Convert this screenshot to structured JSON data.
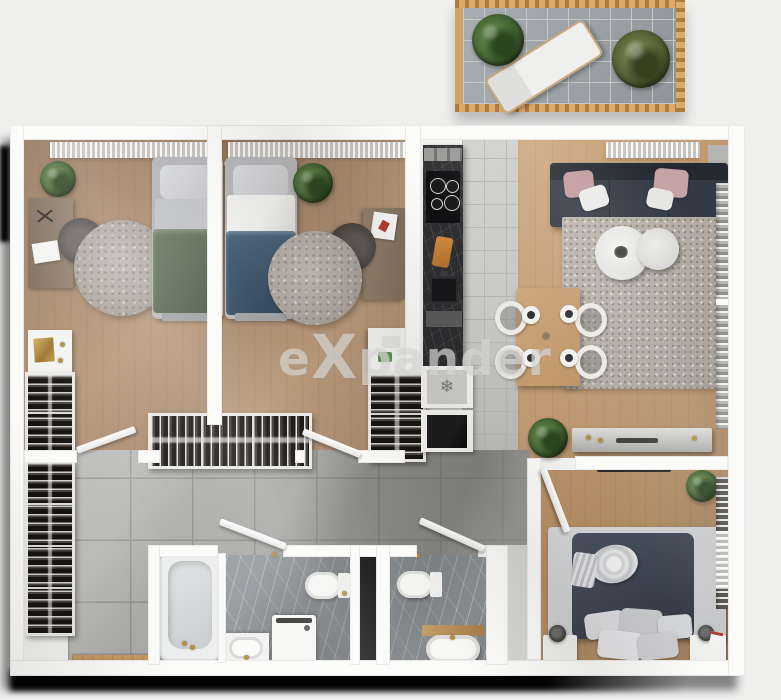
{
  "watermark": {
    "prefix": "e",
    "x": "X",
    "suffix": "pander"
  },
  "icons": {
    "snowflake": "❄"
  },
  "palette": {
    "bg": "#efefee",
    "wall": "#fbfbfa",
    "shadow": "#050505",
    "wood_bedroom": "#a5876a",
    "wood_living": "#c39c73",
    "wood_bedroom3": "#ad8a61",
    "tile_kitchen": "#c6c6c4",
    "tile_hallway": "#a5a5a3",
    "marble_bathroom": "#8d9296",
    "counter_dark": "#29292c",
    "sofa_navy": "#333a45",
    "duvet_green": "#5f7059",
    "duvet_blue": "#41586e",
    "duvet_navy": "#3c4350",
    "pillow_pink": "#c29a9e",
    "rug_gray": "#b0aaa2",
    "balcony_wood": "#d2a264",
    "balcony_tile": "#9ba1a4",
    "plant_green": "#3c5a2e",
    "gold": "#b08c3e",
    "watermark_gray": "#e2e2e0"
  },
  "scene": {
    "type": "3d-apartment-floor-plan-top-view",
    "balcony": {
      "furniture": [
        "sun-lounger",
        "plant",
        "plant"
      ]
    },
    "rooms": [
      {
        "name": "bedroom-1",
        "furniture": [
          "single-bed-green",
          "desk",
          "desk-chair",
          "round-rug",
          "plant",
          "shelf",
          "open-wardrobe"
        ]
      },
      {
        "name": "bedroom-2",
        "furniture": [
          "single-bed-blue",
          "desk",
          "desk-chair",
          "round-rug",
          "plant",
          "shelf",
          "drawer-unit"
        ]
      },
      {
        "name": "kitchen",
        "furniture": [
          "counter-dark-marble",
          "cooktop-4-burners",
          "cutting-board",
          "sink",
          "fridge-with-snowflake",
          "oven"
        ]
      },
      {
        "name": "living-room",
        "furniture": [
          "sofa-navy",
          "pink-pillows",
          "area-rug",
          "round-coffee-table-large",
          "round-coffee-table-small",
          "dining-table",
          "four-chairs",
          "four-place-settings",
          "sideboard",
          "plant",
          "window-blinds"
        ]
      },
      {
        "name": "hallway",
        "furniture": [
          "open-wardrobe-left",
          "open-wardrobe-top",
          "entrance-mat",
          "doors"
        ]
      },
      {
        "name": "bathroom-1",
        "furniture": [
          "bathtub",
          "washing-machine",
          "sink-vanity",
          "toilet"
        ]
      },
      {
        "name": "bathroom-2",
        "furniture": [
          "toilet",
          "sink-vanity-wood"
        ]
      },
      {
        "name": "bedroom-3",
        "furniture": [
          "double-bed-navy",
          "pillows",
          "nightstand-left",
          "nightstand-right",
          "lamps",
          "tv",
          "plant",
          "window-shutters"
        ]
      }
    ]
  }
}
